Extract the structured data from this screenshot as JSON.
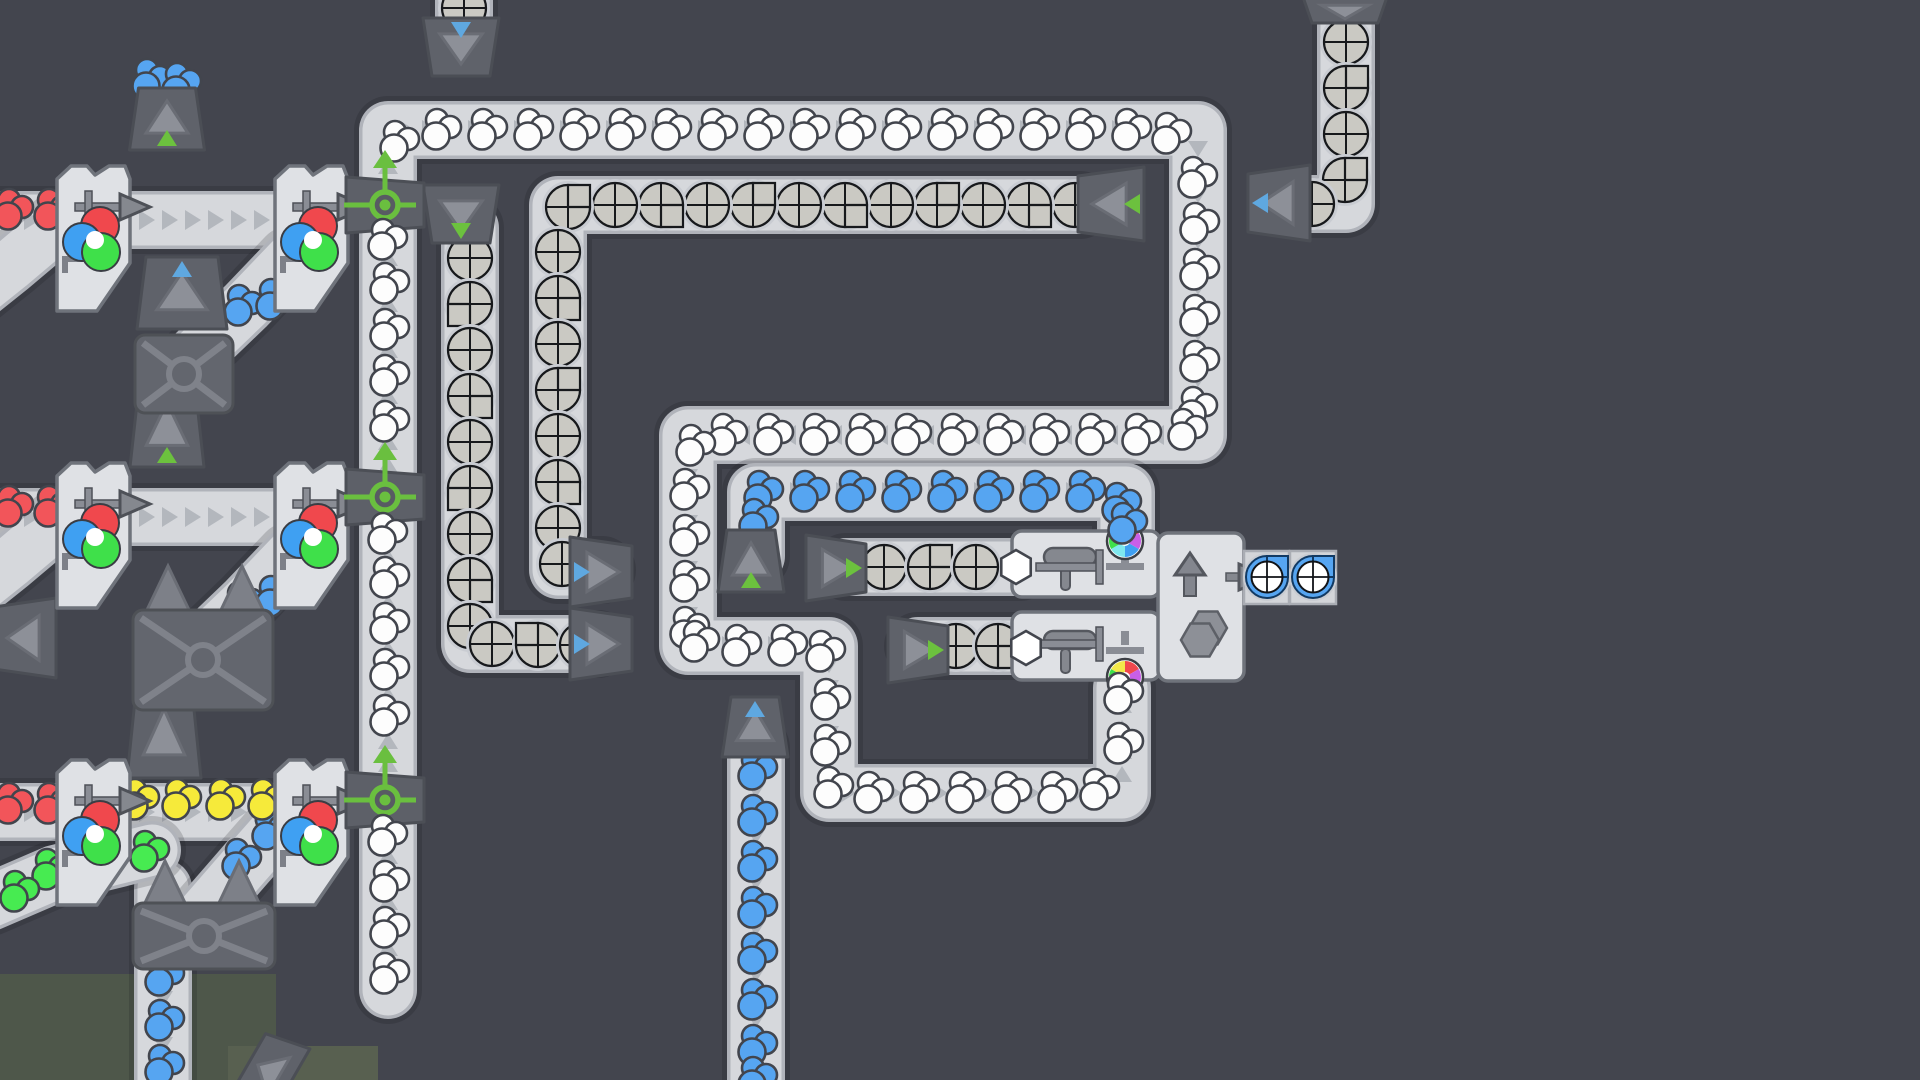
{
  "meta": {
    "app": "shapez-factory-view",
    "canvas_w": 1920,
    "canvas_h": 1080,
    "colors": {
      "bg": "#43454e",
      "belt_shadow": "rgba(20,22,28,0.18)",
      "belt_edge": "#b0b3ba",
      "belt_fill": "#d6d8dc",
      "chevron": "rgba(100,105,118,0.30)",
      "dark_machine": "#5f626a",
      "dark_machine_stroke": "#4b4e55",
      "mid_gray": "#8d9098",
      "mid_gray_stroke": "#6a6d75",
      "light_machine": "#dfe1e5",
      "light_machine_stroke": "#6f737b",
      "pipe": "#8a8d95",
      "pipe_stroke": "#4e5158",
      "item_stroke": "#42454d",
      "white": "#fdfdfd",
      "blue": "#56a5f1",
      "red": "#f2555a",
      "yellow": "#f6ea3a",
      "green": "#47eb51",
      "node_green": "#6abf3f",
      "tri_green": "#6cc13e",
      "tri_blue": "#5fa8e0",
      "quad_fill": "#cac9c3",
      "quad_halo": "#c9ccd2",
      "quad_stroke": "#17191c",
      "terrain1": "#4e574a",
      "terrain2": "#586050",
      "mix_red": "#f0484d",
      "mix_blue": "#3fa0f2",
      "mix_green": "#3fe04a",
      "wheel": [
        "#f0484d",
        "#c95fe8",
        "#3fa0f2",
        "#7fe8ef",
        "#3fe04a",
        "#f2e84a"
      ]
    },
    "belt_width": 58,
    "chevron_spacing": 23
  },
  "belts": [
    {
      "name": "white-main-loop",
      "pts": [
        [
          388,
          990
        ],
        [
          388,
          130
        ],
        [
          1198,
          130
        ],
        [
          1198,
          435
        ],
        [
          688,
          435
        ],
        [
          688,
          646
        ],
        [
          829,
          646
        ],
        [
          829,
          793
        ],
        [
          1122,
          793
        ],
        [
          1122,
          688
        ]
      ],
      "chev": true
    },
    {
      "name": "blue-mid-run",
      "pts": [
        [
          756,
          556
        ],
        [
          756,
          492
        ],
        [
          1126,
          492
        ],
        [
          1126,
          548
        ]
      ],
      "chev": true
    },
    {
      "name": "blue-bottom-column",
      "pts": [
        [
          756,
          748
        ],
        [
          756,
          1086
        ]
      ],
      "chev": true
    },
    {
      "name": "blue-left-column",
      "pts": [
        [
          163,
          888
        ],
        [
          163,
          1086
        ]
      ],
      "chev": true
    },
    {
      "name": "gray-topright-column",
      "pts": [
        [
          1346,
          -8
        ],
        [
          1346,
          204
        ],
        [
          1298,
          204
        ]
      ],
      "chev": false
    },
    {
      "name": "gray-long-row",
      "pts": [
        [
          1080,
          205
        ],
        [
          558,
          205
        ],
        [
          558,
          570
        ],
        [
          602,
          570
        ]
      ],
      "chev": true
    },
    {
      "name": "gray-left-column",
      "pts": [
        [
          470,
          228
        ],
        [
          470,
          644
        ],
        [
          598,
          644
        ]
      ],
      "chev": true
    },
    {
      "name": "painter-row-1",
      "pts": [
        [
          846,
          567
        ],
        [
          1020,
          567
        ]
      ],
      "chev": false
    },
    {
      "name": "painter-row-2",
      "pts": [
        [
          918,
          646
        ],
        [
          1030,
          646
        ]
      ],
      "chev": false
    },
    {
      "name": "row1-left-stub",
      "pts": [
        [
          -10,
          220
        ],
        [
          60,
          220
        ]
      ],
      "chev": true
    },
    {
      "name": "row1-mid",
      "pts": [
        [
          128,
          220
        ],
        [
          278,
          220
        ]
      ],
      "chev": true
    },
    {
      "name": "row2-left-stub",
      "pts": [
        [
          -10,
          517
        ],
        [
          60,
          517
        ]
      ],
      "chev": true
    },
    {
      "name": "row2-mid",
      "pts": [
        [
          128,
          517
        ],
        [
          278,
          517
        ]
      ],
      "chev": true
    },
    {
      "name": "row3-left-stub",
      "pts": [
        [
          -10,
          812
        ],
        [
          60,
          812
        ]
      ],
      "chev": true
    },
    {
      "name": "row3-mid",
      "pts": [
        [
          128,
          812
        ],
        [
          278,
          812
        ]
      ],
      "chev": true
    },
    {
      "name": "row1-a-curve",
      "pts": [
        [
          55,
          228
        ],
        [
          10,
          266
        ],
        [
          -35,
          302
        ]
      ],
      "chev": false
    },
    {
      "name": "row2-a-curve",
      "pts": [
        [
          55,
          525
        ],
        [
          10,
          563
        ],
        [
          -35,
          599
        ]
      ],
      "chev": false
    },
    {
      "name": "row3-a-curve",
      "pts": [
        [
          152,
          850
        ],
        [
          55,
          874
        ],
        [
          -10,
          902
        ]
      ],
      "chev": false
    },
    {
      "name": "row1-b-curve",
      "pts": [
        [
          196,
          354
        ],
        [
          246,
          306
        ],
        [
          290,
          260
        ]
      ],
      "chev": false
    },
    {
      "name": "row2-b-curve",
      "pts": [
        [
          196,
          650
        ],
        [
          246,
          602
        ],
        [
          290,
          556
        ]
      ],
      "chev": false
    },
    {
      "name": "row3-b-curve",
      "pts": [
        [
          200,
          917
        ],
        [
          246,
          864
        ],
        [
          290,
          814
        ]
      ],
      "chev": false
    },
    {
      "name": "top-stub",
      "pts": [
        [
          464,
          -10
        ],
        [
          464,
          24
        ]
      ],
      "chev": false
    }
  ],
  "items": {
    "white": [
      [
        388,
        284
      ],
      [
        388,
        330
      ],
      [
        388,
        376
      ],
      [
        388,
        422
      ],
      [
        388,
        578
      ],
      [
        388,
        624
      ],
      [
        388,
        670
      ],
      [
        388,
        716
      ],
      [
        388,
        882
      ],
      [
        388,
        928
      ],
      [
        388,
        974
      ],
      [
        398,
        142
      ],
      [
        440,
        130
      ],
      [
        486,
        130
      ],
      [
        532,
        130
      ],
      [
        578,
        130
      ],
      [
        624,
        130
      ],
      [
        670,
        130
      ],
      [
        716,
        130
      ],
      [
        762,
        130
      ],
      [
        808,
        130
      ],
      [
        854,
        130
      ],
      [
        900,
        130
      ],
      [
        946,
        130
      ],
      [
        992,
        130
      ],
      [
        1038,
        130
      ],
      [
        1084,
        130
      ],
      [
        1130,
        130
      ],
      [
        1170,
        134
      ],
      [
        1196,
        178
      ],
      [
        1198,
        224
      ],
      [
        1198,
        270
      ],
      [
        1198,
        316
      ],
      [
        1198,
        362
      ],
      [
        1196,
        408
      ],
      [
        1186,
        430
      ],
      [
        1140,
        435
      ],
      [
        1094,
        435
      ],
      [
        1048,
        435
      ],
      [
        1002,
        435
      ],
      [
        956,
        435
      ],
      [
        910,
        435
      ],
      [
        864,
        435
      ],
      [
        818,
        435
      ],
      [
        772,
        435
      ],
      [
        726,
        435
      ],
      [
        694,
        446
      ],
      [
        688,
        490
      ],
      [
        688,
        536
      ],
      [
        688,
        582
      ],
      [
        688,
        628
      ],
      [
        698,
        642
      ],
      [
        740,
        646
      ],
      [
        786,
        646
      ],
      [
        824,
        652
      ],
      [
        829,
        700
      ],
      [
        829,
        746
      ],
      [
        832,
        788
      ],
      [
        872,
        793
      ],
      [
        918,
        793
      ],
      [
        964,
        793
      ],
      [
        1010,
        793
      ],
      [
        1056,
        793
      ],
      [
        1098,
        790
      ],
      [
        1122,
        744
      ]
    ],
    "blue": [
      [
        762,
        492
      ],
      [
        808,
        492
      ],
      [
        854,
        492
      ],
      [
        900,
        492
      ],
      [
        946,
        492
      ],
      [
        992,
        492
      ],
      [
        1038,
        492
      ],
      [
        1084,
        492
      ],
      [
        1120,
        504
      ],
      [
        757,
        520
      ],
      [
        756,
        770
      ],
      [
        756,
        816
      ],
      [
        756,
        862
      ],
      [
        756,
        908
      ],
      [
        756,
        954
      ],
      [
        756,
        1000
      ],
      [
        756,
        1046
      ],
      [
        756,
        1078
      ],
      [
        163,
        976
      ],
      [
        163,
        1021
      ],
      [
        163,
        1066
      ],
      [
        242,
        306
      ],
      [
        274,
        300
      ],
      [
        242,
        603
      ],
      [
        274,
        597
      ],
      [
        240,
        860
      ],
      [
        270,
        830
      ],
      [
        150,
        80
      ],
      [
        180,
        84
      ],
      [
        152,
        376
      ],
      [
        182,
        380
      ]
    ],
    "red": [
      [
        12,
        210
      ],
      [
        52,
        210
      ],
      [
        12,
        507
      ],
      [
        52,
        507
      ],
      [
        12,
        804
      ],
      [
        52,
        804
      ]
    ],
    "yellow": [
      [
        138,
        800
      ],
      [
        180,
        800
      ],
      [
        224,
        800
      ],
      [
        266,
        800
      ]
    ],
    "green": [
      [
        148,
        852
      ],
      [
        50,
        870
      ],
      [
        18,
        892
      ]
    ]
  },
  "quads": [
    [
      1346,
      42,
      ""
    ],
    [
      1346,
      88,
      "ne"
    ],
    [
      1346,
      134,
      ""
    ],
    [
      1345,
      180,
      "ne"
    ],
    [
      1312,
      204,
      ""
    ],
    [
      1075,
      205,
      ""
    ],
    [
      1029,
      205,
      "se"
    ],
    [
      983,
      205,
      ""
    ],
    [
      937,
      205,
      "ne"
    ],
    [
      891,
      205,
      ""
    ],
    [
      845,
      205,
      "se"
    ],
    [
      799,
      205,
      ""
    ],
    [
      753,
      205,
      "ne"
    ],
    [
      707,
      205,
      ""
    ],
    [
      661,
      205,
      "se"
    ],
    [
      615,
      205,
      ""
    ],
    [
      568,
      207,
      "ne"
    ],
    [
      558,
      252,
      ""
    ],
    [
      558,
      298,
      "se"
    ],
    [
      558,
      344,
      ""
    ],
    [
      558,
      390,
      "ne"
    ],
    [
      558,
      436,
      ""
    ],
    [
      558,
      482,
      "se"
    ],
    [
      558,
      528,
      ""
    ],
    [
      562,
      564,
      ""
    ],
    [
      470,
      258,
      ""
    ],
    [
      470,
      304,
      "nw"
    ],
    [
      470,
      350,
      ""
    ],
    [
      470,
      396,
      "se"
    ],
    [
      470,
      442,
      ""
    ],
    [
      470,
      488,
      "nw"
    ],
    [
      470,
      534,
      ""
    ],
    [
      470,
      580,
      "se"
    ],
    [
      470,
      626,
      ""
    ],
    [
      492,
      644,
      ""
    ],
    [
      538,
      645,
      "sw"
    ],
    [
      582,
      645,
      ""
    ],
    [
      884,
      567,
      ""
    ],
    [
      930,
      567,
      "ne"
    ],
    [
      976,
      567,
      ""
    ],
    [
      956,
      646,
      ""
    ],
    [
      998,
      646,
      "se"
    ],
    [
      464,
      8,
      ""
    ]
  ],
  "node_blobs": [
    [
      386,
      240
    ],
    [
      386,
      534
    ],
    [
      386,
      836
    ]
  ],
  "port_items": {
    "hexes": [
      [
        1016,
        567
      ],
      [
        1026,
        648
      ]
    ],
    "white_port": [
      1122,
      694
    ],
    "blue_port": [
      1126,
      524
    ]
  },
  "stacked_items": [
    [
      1267,
      577
    ],
    [
      1313,
      577
    ]
  ],
  "mixers": [
    {
      "x": 57,
      "y": 163
    },
    {
      "x": 275,
      "y": 163
    },
    {
      "x": 57,
      "y": 460
    },
    {
      "x": 275,
      "y": 460
    },
    {
      "x": 57,
      "y": 757
    },
    {
      "x": 275,
      "y": 757
    }
  ],
  "nodes": [
    {
      "cx": 385,
      "cy": 205
    },
    {
      "cx": 385,
      "cy": 497
    },
    {
      "cx": 385,
      "cy": 800
    }
  ],
  "tunnels": [
    {
      "cx": 461,
      "cy": 47,
      "lw": 76,
      "lh": 58,
      "rot": 180,
      "small": "blue",
      "side": "s"
    },
    {
      "cx": 1345,
      "cy": 10,
      "lw": 84,
      "lh": 26,
      "rot": 180,
      "small": null,
      "side": "s"
    },
    {
      "cx": 461,
      "cy": 214,
      "lw": 76,
      "lh": 58,
      "rot": 180,
      "small": "green",
      "side": "n"
    },
    {
      "cx": 167,
      "cy": 119,
      "lw": 75,
      "lh": 62,
      "rot": 0,
      "small": "green",
      "side": "s"
    },
    {
      "cx": 167,
      "cy": 426,
      "lw": 74,
      "lh": 82,
      "rot": 0,
      "small": "green",
      "side": "s"
    },
    {
      "cx": 164,
      "cy": 734,
      "lw": 74,
      "lh": 88,
      "rot": 0,
      "small": "green",
      "side": "n"
    },
    {
      "cx": 182,
      "cy": 293,
      "lw": 90,
      "lh": 72,
      "rot": 0,
      "small": "blue",
      "side": "n"
    },
    {
      "cx": 751,
      "cy": 561,
      "lw": 66,
      "lh": 62,
      "rot": 0,
      "small": "green",
      "side": "s"
    },
    {
      "cx": 755,
      "cy": 727,
      "lw": 66,
      "lh": 60,
      "rot": 0,
      "small": "blue",
      "side": "n"
    },
    {
      "cx": 601,
      "cy": 572,
      "lw": 70,
      "lh": 62,
      "rot": 90,
      "small": "blue",
      "side": "e"
    },
    {
      "cx": 601,
      "cy": 644,
      "lw": 72,
      "lh": 62,
      "rot": 90,
      "small": "blue",
      "side": "e"
    },
    {
      "cx": 836,
      "cy": 568,
      "lw": 66,
      "lh": 60,
      "rot": 90,
      "small": "green",
      "side": "w"
    },
    {
      "cx": 918,
      "cy": 650,
      "lw": 66,
      "lh": 60,
      "rot": 90,
      "small": "green",
      "side": "w"
    },
    {
      "cx": 1111,
      "cy": 204,
      "lw": 74,
      "lh": 66,
      "rot": 270,
      "small": "green",
      "side": "e"
    },
    {
      "cx": 1279,
      "cy": 203,
      "lw": 76,
      "lh": 62,
      "rot": 270,
      "small": "blue",
      "side": "w"
    },
    {
      "cx": 25,
      "cy": 638,
      "lw": 80,
      "lh": 62,
      "rot": 270,
      "small": null,
      "side": "w"
    },
    {
      "cx": 270,
      "cy": 1072,
      "lw": 80,
      "lh": 46,
      "rot": 300,
      "small": null,
      "side": "w"
    }
  ],
  "tri_pairs": [
    [
      168,
      589
    ],
    [
      242,
      589
    ],
    [
      165,
      884
    ],
    [
      239,
      884
    ]
  ],
  "xboxes": [
    {
      "x": 135,
      "y": 335,
      "w": 98,
      "h": 78
    },
    {
      "x": 133,
      "y": 610,
      "w": 140,
      "h": 100
    },
    {
      "x": 133,
      "y": 903,
      "w": 142,
      "h": 66
    }
  ],
  "painters": [
    {
      "x": 1012,
      "y": 531,
      "w": 148,
      "h": 66,
      "wheel": [
        1125,
        541
      ],
      "wheel_side": "n",
      "roller": [
        1070,
        557
      ]
    },
    {
      "x": 1012,
      "y": 612,
      "w": 148,
      "h": 68,
      "wheel": [
        1125,
        677
      ],
      "wheel_side": "s",
      "roller": [
        1070,
        640
      ]
    }
  ],
  "stacker": {
    "x": 1158,
    "y": 533,
    "w": 86,
    "h": 148,
    "arrow": [
      1190,
      576
    ],
    "hex": [
      1200,
      634
    ],
    "out": [
      1240,
      577
    ]
  },
  "beltcaps": [
    {
      "x": 1244,
      "y": 551,
      "w": 45,
      "h": 53
    },
    {
      "x": 1290,
      "y": 551,
      "w": 46,
      "h": 53
    }
  ],
  "terrain": [
    {
      "x": 0,
      "y": 974,
      "w": 276,
      "h": 106,
      "tone": 1
    },
    {
      "x": 228,
      "y": 1046,
      "w": 150,
      "h": 34,
      "tone": 2
    }
  ]
}
